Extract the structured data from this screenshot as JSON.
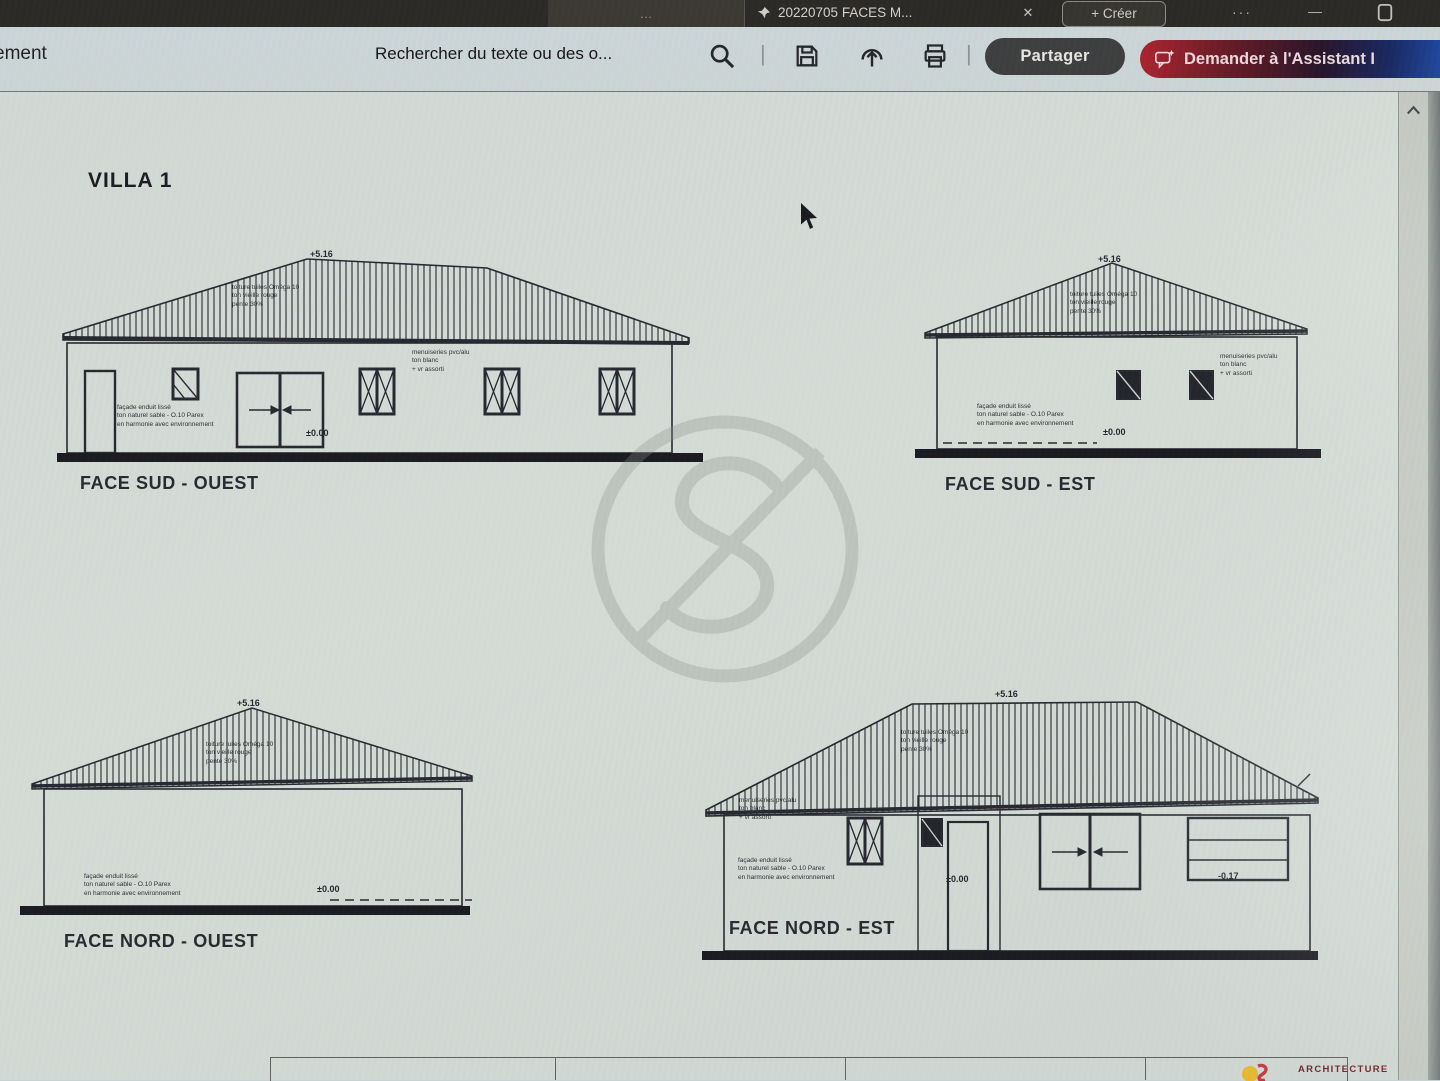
{
  "colors": {
    "accent_red": "#a91f2a",
    "accent_blue": "#1e55c0",
    "share_bg": "#3b3b3b",
    "logo_yellow": "#e9b72b",
    "logo_red": "#c23540",
    "drawing_ink": "#23242b"
  },
  "icons": {
    "pin": "pin-icon",
    "close": "✕",
    "more": "···",
    "minimize": "—",
    "window_restore": "square-icon",
    "search": "search-icon",
    "save": "save-icon",
    "upload": "upload-icon",
    "print": "print-icon",
    "assistant_chat": "chat-sparkle-icon",
    "scroll_up": "chevron-up-icon",
    "divider": "|"
  },
  "tabbar": {
    "prev_tab": "…",
    "active_tab": "20220705 FACES M...",
    "create": "+ Créer"
  },
  "toolbar": {
    "menu_partial": "ement",
    "search_text": "Rechercher du texte ou des o...",
    "share": "Partager",
    "assistant": "Demander à l'Assistant I"
  },
  "document": {
    "title": "VILLA 1",
    "elevations": [
      {
        "name": "FACE SUD - OUEST",
        "ridge_level": "+5.16",
        "floor_level": "±0.00",
        "roof_note": "toiture tuiles Oméga 10\nton vieille rouge\npente 30%",
        "joinery_note": "menuiseries pvc/alu\nton blanc\n+ vr assorti",
        "facade_note": "façade enduit lissé\nton naturel sable - O.10 Parex\nen harmonie avec environnement"
      },
      {
        "name": "FACE SUD - EST",
        "ridge_level": "+5.16",
        "floor_level": "±0.00",
        "roof_note": "toiture tuiles Oméga 10\nton vieille rouge\npente 30%",
        "joinery_note": "menuiseries pvc/alu\nton blanc\n+ vr assorti",
        "facade_note": "façade enduit lissé\nton naturel sable - O.10 Parex\nen harmonie avec environnement"
      },
      {
        "name": "FACE NORD - OUEST",
        "ridge_level": "+5.16",
        "floor_level": "±0.00",
        "roof_note": "toiture tuiles Oméga 10\nton vieille rouge\npente 30%",
        "facade_note": "façade enduit lissé\nton naturel sable - O.10 Parex\nen harmonie avec environnement"
      },
      {
        "name": "FACE NORD - EST",
        "ridge_level": "+5.16",
        "floor_level": "±0.00",
        "garage_level": "-0.17",
        "roof_note": "toiture tuiles Oméga 10\nton vieille rouge\npente 30%",
        "joinery_note": "menuiseries pvc/alu\nton blanc\n+ vr assorti",
        "facade_note": "façade enduit lissé\nton naturel sable - O.10 Parex\nen harmonie avec environnement"
      }
    ],
    "titleblock": {
      "brand": "ARCHITECTURE"
    }
  }
}
